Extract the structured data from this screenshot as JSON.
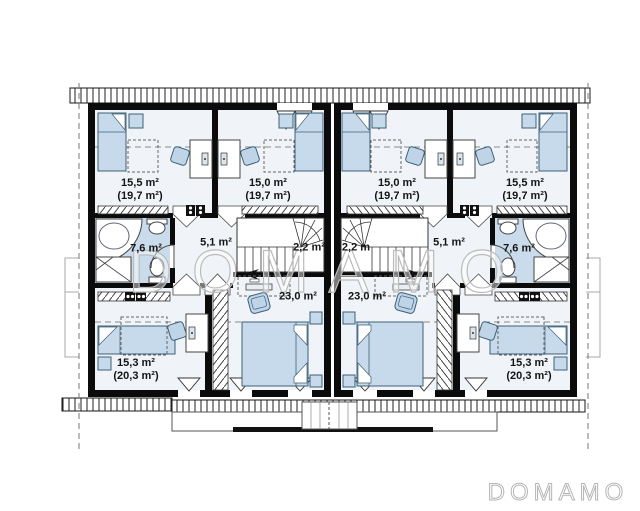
{
  "watermark": {
    "text": "DOMAMO"
  },
  "logo": {
    "text": "DOMAMO"
  },
  "colors": {
    "wall": "#0b0b0b",
    "floor": "#f0f4f8",
    "bathroom_fill": "#cadcec",
    "furniture_fill": "#c7daeb",
    "chair_fill": "#bfd4e7",
    "furniture_stroke": "#3c5f78",
    "watermark_gray": "#bcbcbc"
  },
  "floor_plan": {
    "type": "duplex-upper-floor-plan",
    "rooms": [
      {
        "name": "bedroom-top-far-left",
        "label": "15,5 m²",
        "sublabel": "(19,7 m²)"
      },
      {
        "name": "bedroom-top-mid-left",
        "label": "15,0 m²",
        "sublabel": "(19,7 m²)"
      },
      {
        "name": "bedroom-top-mid-right",
        "label": "15,0 m²",
        "sublabel": "(19,7 m²)"
      },
      {
        "name": "bedroom-top-far-right",
        "label": "15,5 m²",
        "sublabel": "(19,7 m²)"
      },
      {
        "name": "bathroom-left",
        "label": "7,6 m²"
      },
      {
        "name": "hallway-left",
        "label": "5,1 m²"
      },
      {
        "name": "stair-room-left",
        "label": "2,2 m²"
      },
      {
        "name": "stair-room-right",
        "label": "2,2 m"
      },
      {
        "name": "hallway-right",
        "label": "5,1 m²"
      },
      {
        "name": "bathroom-right",
        "label": "7,6 m²"
      },
      {
        "name": "bedroom-center-left",
        "label": "23,0 m²"
      },
      {
        "name": "bedroom-center-right",
        "label": "23,0 m²"
      },
      {
        "name": "bedroom-bottom-left",
        "label": "15,3 m²",
        "sublabel": "(20,3 m²)"
      },
      {
        "name": "bedroom-bottom-right",
        "label": "15,3 m²",
        "sublabel": "(20,3 m²)"
      }
    ]
  }
}
